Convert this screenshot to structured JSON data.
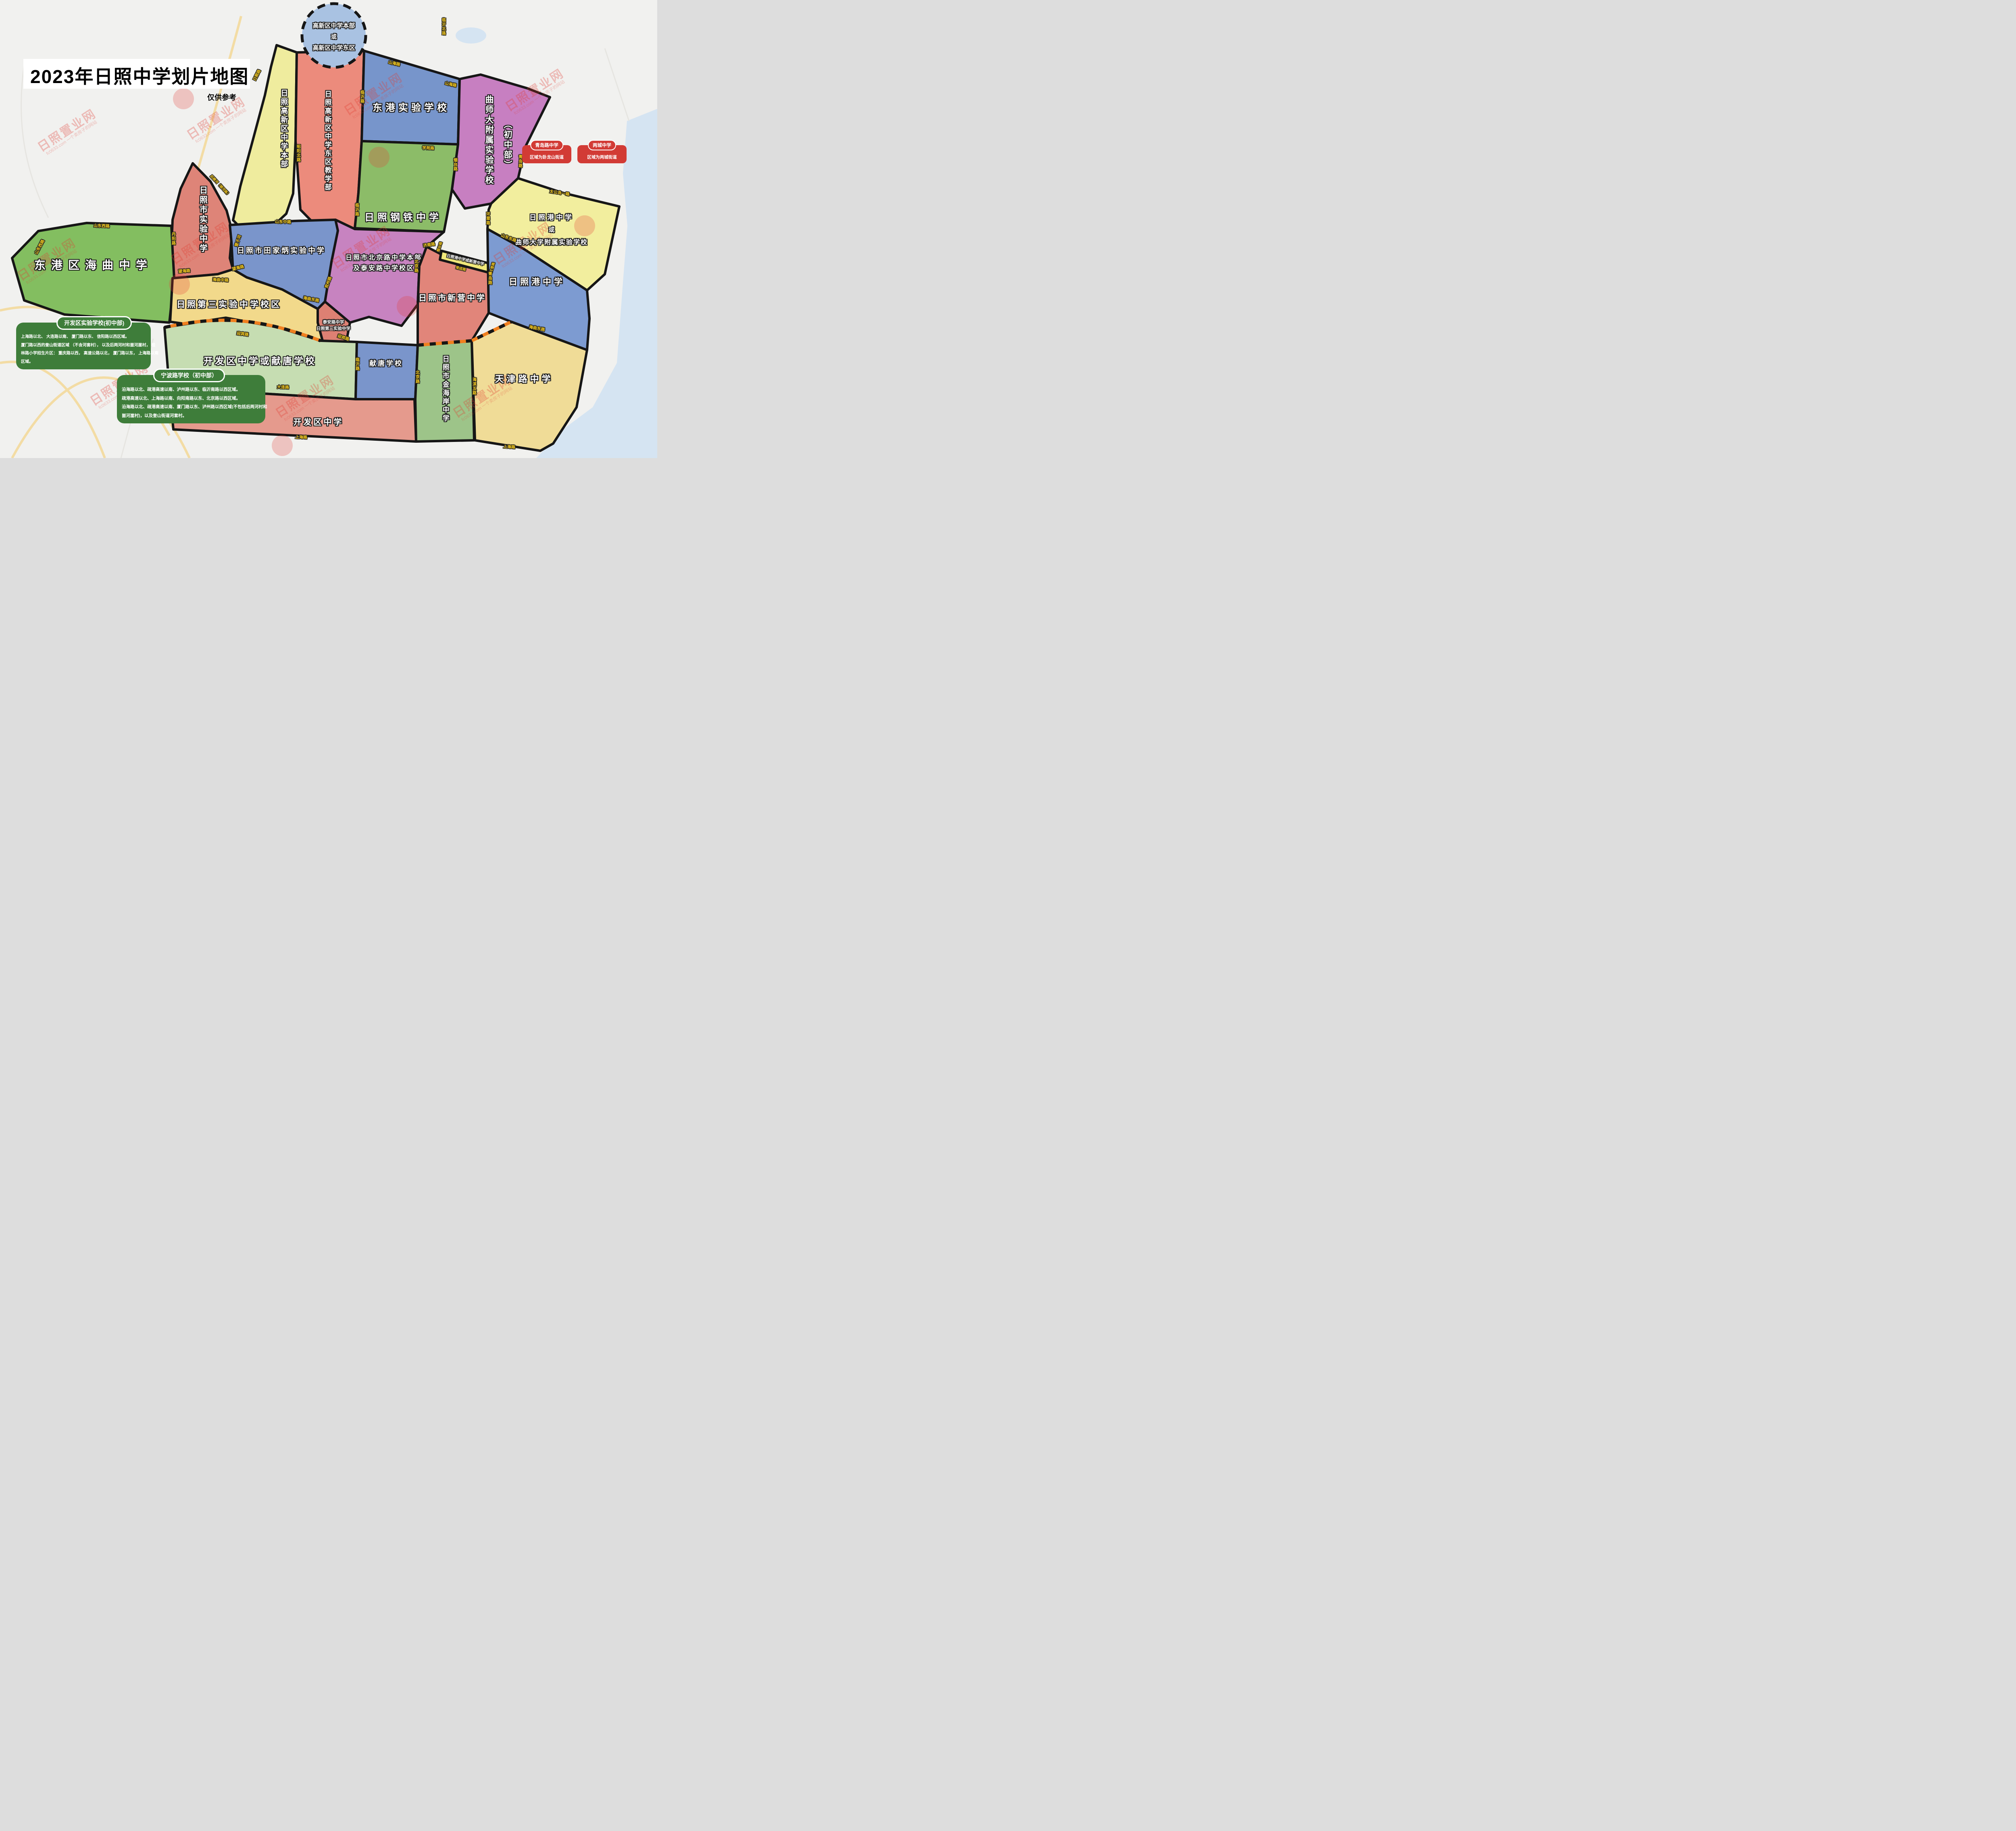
{
  "title": {
    "text": "2023年日照中学划片地图",
    "subtitle": "仅供参考"
  },
  "watermark": {
    "name": "日照置业网",
    "site": "fc0633.com 一个卖房子的网站"
  },
  "circle_zone": {
    "line1": "高新区中学本部",
    "line2": "或",
    "line3": "高新区中学东区"
  },
  "zones": {
    "gaoxin_benbu": "日照高新区中学本部",
    "gaoxin_dongqu": "日照高新区中学东区教学部",
    "donggang_shiyan": "东港实验学校",
    "gangtie": "日照钢铁中学",
    "qushida_fushu": "曲师大附属实验学校",
    "qushida_fushu_suffix": "（初中部）",
    "port_or_qushida_l1": "日照港中学",
    "port_or_qushida_l2": "或",
    "port_or_qushida_l3": "曲师大学附属实验学校",
    "shiyan": "日照市实验中学",
    "haiqu": "东港区海曲中学",
    "tianjiabing": "日照市田家炳实验中学",
    "beijinglu_l1": "日照市北京路中学本部",
    "beijinglu_l2": "及泰安路中学校区",
    "sanshiyan": "日照第三实验中学校区",
    "taian_l1": "泰安路中学",
    "taian_l2": "日照第三实验中学",
    "xinying": "日照市新营中学",
    "port_or_xinying_strip": "日照港中学或新营中学",
    "rizhao_port": "日照港中学",
    "kaifaqu_or_xiantang": "开发区中学或献唐学校",
    "xiantang": "献唐学校",
    "kaifaqu": "开发区中学",
    "jinhaian": "日照市金海岸中学",
    "tianjinlu": "天津路中学"
  },
  "red_boxes": [
    {
      "title": "青岛路中学",
      "body": "区域为卧龙山街道"
    },
    {
      "title": "两城中学",
      "body": "区域为两城街道"
    }
  ],
  "green_boxes": [
    {
      "title": "开发区实验学校(初中部)",
      "line1": "上海路以北、 大连路以南、 厦门路以东、 信阳路以西区域。",
      "line2": "厦门路以西的奎山街道区域 （不含河套村）， 以及后两河村和崮河崖村， 桂",
      "line3": "林路小学招生片区： 重庆路以西， 高速公路以北， 厦门路以东， 上海路以南",
      "line4": "区域。"
    },
    {
      "title": "宁波路学校（初中部）",
      "line1": "沿海路以北、疏港高速以南、泸州路以东、临沂南路以西区域。",
      "line2": "疏港高速以北、上海路以南、向阳南路以东、北京路以西区域。",
      "line3": "沿海路以北、疏港高速以南、厦门路以东、泸州路以西区域(不包括后两河村和",
      "line4": "崮河崖村)，以及奎山街道河套村。"
    }
  ],
  "roads": {
    "shanhai": "山海路",
    "linyi_north": "临沂北路",
    "linyi": "临沂路",
    "zhaoyang_north": "昭阳北路",
    "rizhao": "日照路",
    "xueyuan": "学苑路",
    "yantai": "烟台路",
    "qingdao": "青岛路",
    "taigongdao_yi": "太公岛一路",
    "huancui": "环翠路",
    "shandong_east": "山东东路",
    "danyang": "丹阳路",
    "shandong_west": "山东西路",
    "yingbin": "迎宾路",
    "wanghai": "望海路",
    "haiqu_middle": "海曲中路",
    "haiqu_east": "海曲东路",
    "shandong_middle": "山东中路",
    "yingzi_river": "营子河",
    "houlou_river": "后楼河（银河路）",
    "yanzhou": "兖州路",
    "beijing": "北京路",
    "jinan": "济南路",
    "wendeng": "文登路",
    "rongcheng": "荣成路",
    "dalian": "大连路",
    "qinhuangdao": "秦皇岛路",
    "zhaoyang_south": "昭阳南路",
    "shanghai": "上海路",
    "haibin_wu": "海滨五路"
  },
  "colors": {
    "bg": "#F1F1EF",
    "water": "#D5E4F2",
    "border": "#161616",
    "orange": "#F07F1F",
    "circle_fill": "#A9C2E2",
    "benbu": "#EFEC9E",
    "dongqu": "#EC8B7C",
    "donggang": "#7795CB",
    "gangtie": "#8CBC68",
    "qushida": "#C77FC1",
    "port_yellow": "#F2EE9E",
    "shiyan": "#DE8478",
    "haiqu": "#83BE60",
    "tianjiabing": "#7A95CB",
    "beijinglu": "#C783C0",
    "sanshiyan": "#F2D98B",
    "taian": "#DD8073",
    "xinying": "#E1857A",
    "strip": "#F0E87A",
    "port": "#7D9BD1",
    "kaifaqu_xiantang": "#C6DDB2",
    "xiantang": "#7A95CB",
    "kaifaqu": "#E59A8D",
    "jinhaian": "#9DC489",
    "tianjinlu": "#F0DC97",
    "red_box": "#D23B35",
    "green_box": "#3E7D3A"
  }
}
